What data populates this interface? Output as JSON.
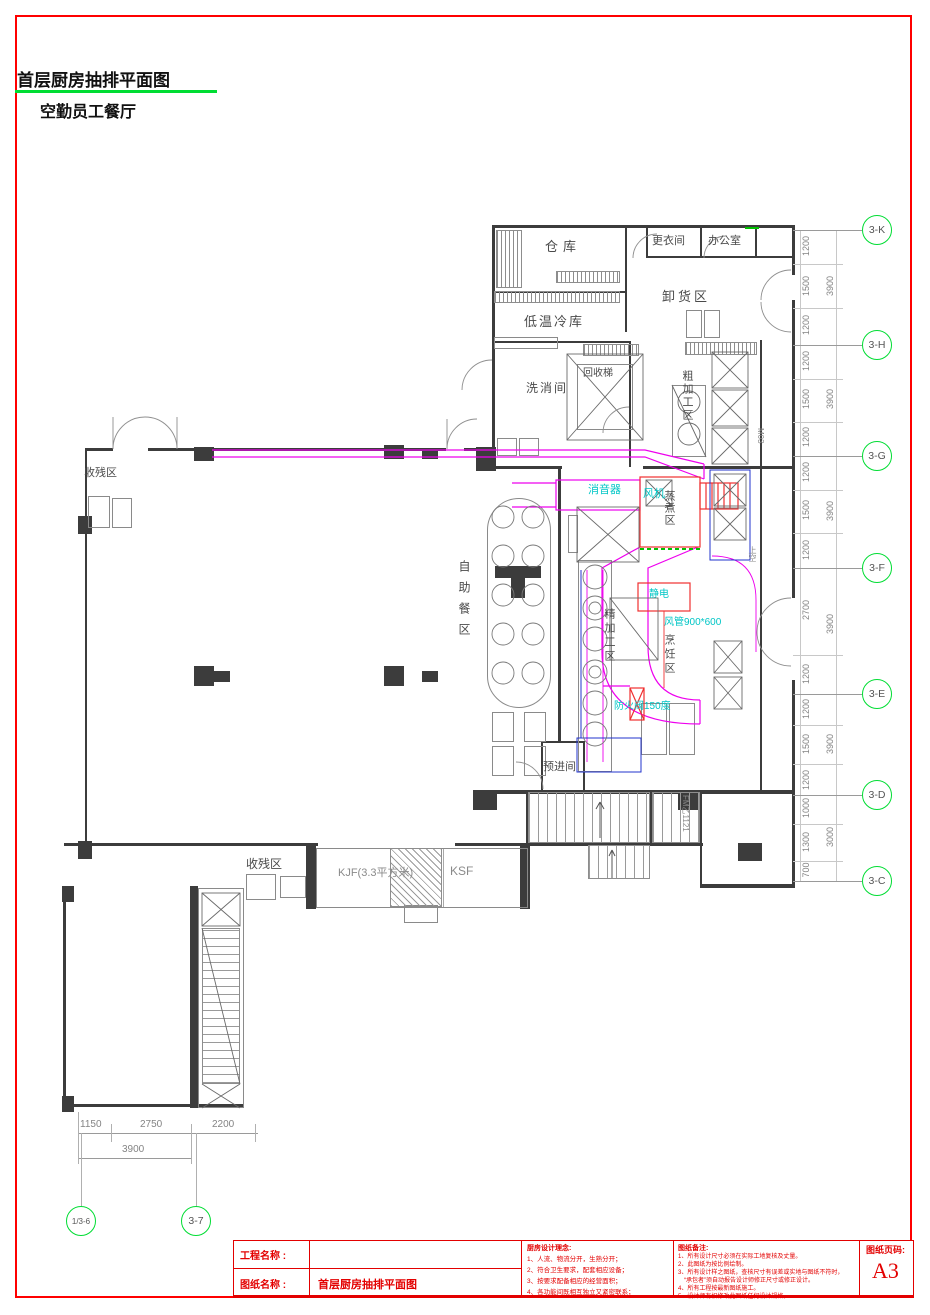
{
  "header": {
    "title": "首层厨房抽排平面图",
    "subtitle": "空勤员工餐厅"
  },
  "colors": {
    "border_red": "#ff0000",
    "grid_green": "#00dd33",
    "duct_magenta": "#ee00ee",
    "annotation_cyan": "#00c6c6",
    "equipment_red": "#f03030",
    "equipment_blue": "#2233cc",
    "wall_gray": "#3c3c3c"
  },
  "plan": {
    "rooms": [
      {
        "id": "storage",
        "label": "仓库"
      },
      {
        "id": "changing-room",
        "label": "更衣间"
      },
      {
        "id": "office",
        "label": "办公室"
      },
      {
        "id": "unloading-area",
        "label": "卸货区"
      },
      {
        "id": "cold-storage",
        "label": "低温冷库"
      },
      {
        "id": "washing-room",
        "label": "洗消间"
      },
      {
        "id": "recycle-lift",
        "label": "回收梯"
      },
      {
        "id": "rough-prep-area",
        "label": "粗加工区"
      },
      {
        "id": "waste-area-1",
        "label": "收残区"
      },
      {
        "id": "buffet-area",
        "label": "自助餐区"
      },
      {
        "id": "steaming-area",
        "label": "蒸煮区"
      },
      {
        "id": "fine-prep-area",
        "label": "精加工区"
      },
      {
        "id": "cooking-area",
        "label": "烹饪区"
      },
      {
        "id": "pre-entry-room",
        "label": "预进间"
      },
      {
        "id": "waste-area-2",
        "label": "收残区"
      },
      {
        "id": "kjf-room",
        "label": "KJF(3.3平方米)"
      },
      {
        "id": "ksf-room",
        "label": "KSF"
      }
    ],
    "annotations": [
      {
        "id": "silencer",
        "label": "消音器"
      },
      {
        "id": "fan",
        "label": "风机"
      },
      {
        "id": "electrostatic-purifier",
        "label": "静电"
      },
      {
        "id": "duct-size",
        "label": "风管900*600"
      },
      {
        "id": "fire-damper",
        "label": "防火阀150度"
      },
      {
        "id": "door-tag-m03",
        "label": "M03"
      },
      {
        "id": "upper-void",
        "label": "上空"
      },
      {
        "id": "fire-door-tag",
        "label": "FM乙1121"
      }
    ]
  },
  "grid_right": {
    "bubbles": [
      "3-K",
      "3-H",
      "3-G",
      "3-F",
      "3-E",
      "3-D",
      "3-C"
    ],
    "dims": [
      "1200",
      "1500",
      "1200",
      "1200",
      "1500",
      "1200",
      "1200",
      "1500",
      "1200",
      "2700",
      "1200",
      "1200",
      "1500",
      "1200",
      "1000",
      "1300",
      "700"
    ],
    "totals": [
      "3900",
      "3900",
      "3900",
      "3900",
      "3900",
      "3000"
    ]
  },
  "grid_bottom": {
    "bubbles": [
      "1/3-6",
      "3-7"
    ],
    "dims": [
      "1150",
      "2750",
      "2200"
    ],
    "total": "3900"
  },
  "title_block": {
    "project_label": "工程名称 :",
    "project_value": "",
    "drawing_label": "图纸名称 :",
    "drawing_value": "首层厨房抽排平面图",
    "concept_title": "厨房设计理念:",
    "concept_items": [
      "1、人流、物流分开，生熟分开；",
      "2、符合卫生要求，配套相应设备；",
      "3、按要求配备相应的经营面积；",
      "4、各功能间既相互独立又紧密联系；"
    ],
    "notes_title": "图纸备注:",
    "notes_items": [
      "1、所有设计尺寸必须在实际工地复核及丈量。",
      "2、此图纸为按比例绘制。",
      "3、所有设计样之图纸，查核尺寸有误差或实地与图纸不符时，",
      "“承包者”须自动报告设计师修正尺寸或修正设计。",
      "4、所有工程按最新图纸施工。",
      "5、设计师有权修改此图纸任何设计规格。"
    ],
    "page_label": "图纸页码:",
    "page_value": "A3"
  }
}
